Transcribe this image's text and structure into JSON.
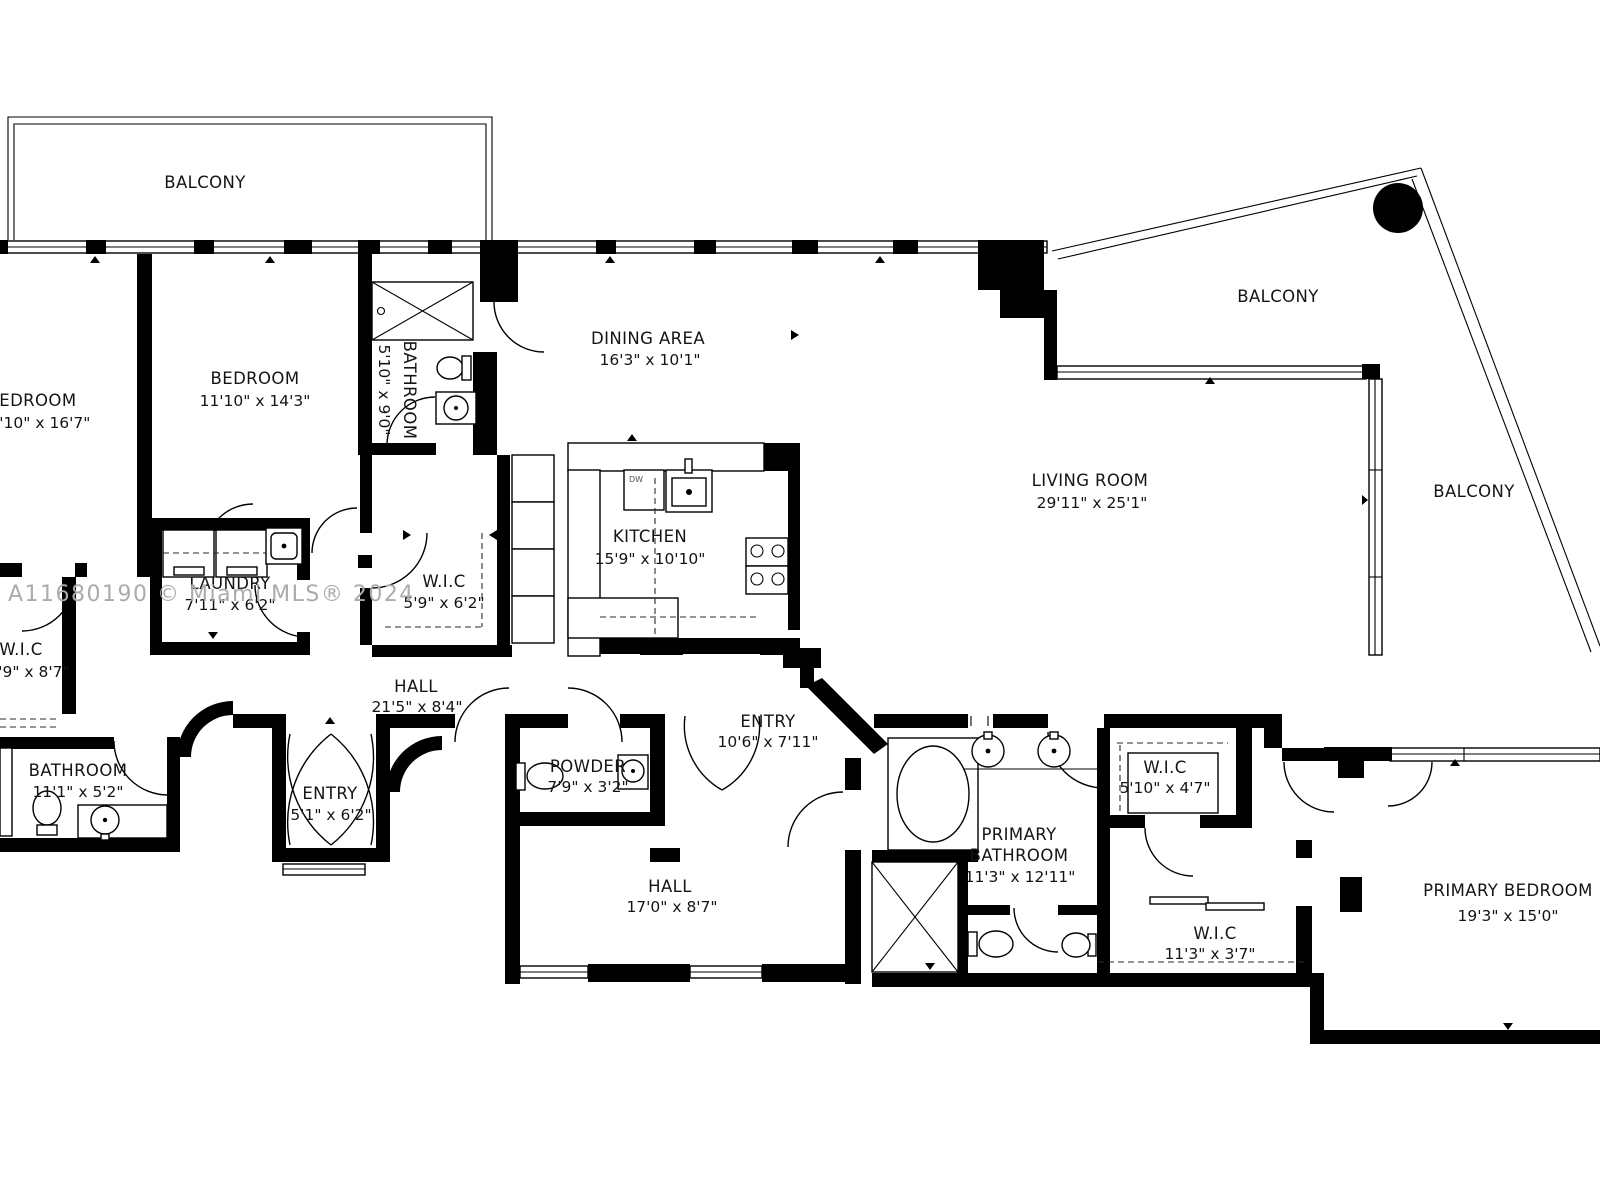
{
  "plan_title": "Residential Floor Plan",
  "watermark": "A11680190 © Miami MLS® 2024",
  "colors": {
    "wall": "#000000",
    "text": "#141414",
    "watermark": "#ababab",
    "background": "#ffffff"
  },
  "rooms": {
    "balcony_top_left": {
      "name": "BALCONY",
      "dims": ""
    },
    "balcony_top_right": {
      "name": "BALCONY",
      "dims": ""
    },
    "balcony_right": {
      "name": "BALCONY",
      "dims": ""
    },
    "bedroom_left": {
      "name": "BEDROOM",
      "dims": "11'10\" x 16'7\""
    },
    "bedroom": {
      "name": "BEDROOM",
      "dims": "11'10\" x 14'3\""
    },
    "bathroom_small": {
      "name": "BATHROOM",
      "dims": "5'10\" x 9'0\""
    },
    "dining_area": {
      "name": "DINING AREA",
      "dims": "16'3\" x 10'1\""
    },
    "kitchen": {
      "name": "KITCHEN",
      "dims": "15'9\" x 10'10\""
    },
    "living_room": {
      "name": "LIVING ROOM",
      "dims": "29'11\" x 25'1\""
    },
    "laundry": {
      "name": "LAUNDRY",
      "dims": "7'11\" x 6'2\""
    },
    "wic_hall": {
      "name": "W.I.C",
      "dims": "5'9\" x 6'2\""
    },
    "wic_left": {
      "name": "W.I.C",
      "dims": "5'9\" x 8'7\""
    },
    "bathroom_left": {
      "name": "BATHROOM",
      "dims": "11'1\" x 5'2\""
    },
    "entry_small": {
      "name": "ENTRY",
      "dims": "5'1\" x 6'2\""
    },
    "hall_upper": {
      "name": "HALL",
      "dims": "21'5\" x 8'4\""
    },
    "powder": {
      "name": "POWDER",
      "dims": "7'9\" x 3'2\""
    },
    "entry_main": {
      "name": "ENTRY",
      "dims": "10'6\" x 7'11\""
    },
    "hall_lower": {
      "name": "HALL",
      "dims": "17'0\" x 8'7\""
    },
    "primary_bathroom": {
      "name_line1": "PRIMARY",
      "name_line2": "BATHROOM",
      "dims": "11'3\" x 12'11\""
    },
    "wic_primary_small": {
      "name": "W.I.C",
      "dims": "5'10\" x 4'7\""
    },
    "wic_primary_long": {
      "name": "W.I.C",
      "dims": "11'3\" x 3'7\""
    },
    "primary_bedroom": {
      "name": "PRIMARY BEDROOM",
      "dims": "19'3\" x 15'0\""
    }
  },
  "appliances": {
    "dishwasher": "DW"
  }
}
